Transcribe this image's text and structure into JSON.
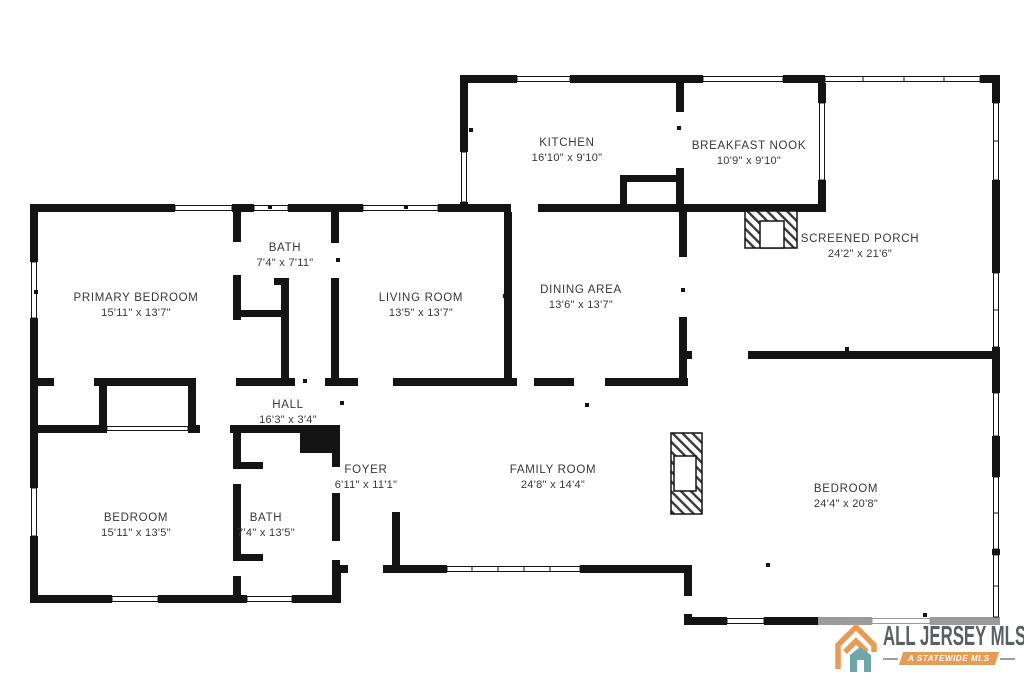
{
  "page": {
    "background": "#ffffff"
  },
  "floorplan": {
    "wall_color": "#141414",
    "accent_wall_color": "#9b9b9b",
    "rooms": {
      "kitchen": {
        "name": "KITCHEN",
        "dims": "16'10\" x 9'10\""
      },
      "breakfast_nook": {
        "name": "BREAKFAST NOOK",
        "dims": "10'9\" x 9'10\""
      },
      "screened_porch": {
        "name": "SCREENED PORCH",
        "dims": "24'2\" x 21'6\""
      },
      "primary_bedroom": {
        "name": "PRIMARY BEDROOM",
        "dims": "15'11\" x 13'7\""
      },
      "bath_upper": {
        "name": "BATH",
        "dims": "7'4\" x 7'11\""
      },
      "living_room": {
        "name": "LIVING ROOM",
        "dims": "13'5\" x 13'7\""
      },
      "dining_area": {
        "name": "DINING AREA",
        "dims": "13'6\" x 13'7\""
      },
      "hall": {
        "name": "HALL",
        "dims": "16'3\" x 3'4\""
      },
      "foyer": {
        "name": "FOYER",
        "dims": "6'11\" x 11'1\""
      },
      "family_room": {
        "name": "FAMILY ROOM",
        "dims": "24'8\" x 14'4\""
      },
      "bedroom_left": {
        "name": "BEDROOM",
        "dims": "15'11\" x 13'5\""
      },
      "bath_lower": {
        "name": "BATH",
        "dims": "7'4\" x 13'5\""
      },
      "bedroom_right": {
        "name": "BEDROOM",
        "dims": "24'4\" x 20'8\""
      }
    }
  },
  "logo": {
    "title": "ALL JERSEY MLS",
    "tagline": "A STATEWIDE MLS",
    "icon": "house-logo-icon",
    "colors": {
      "orange": "#E79C55",
      "teal": "#6FA7A9",
      "text_gray": "#5B5F63"
    }
  }
}
